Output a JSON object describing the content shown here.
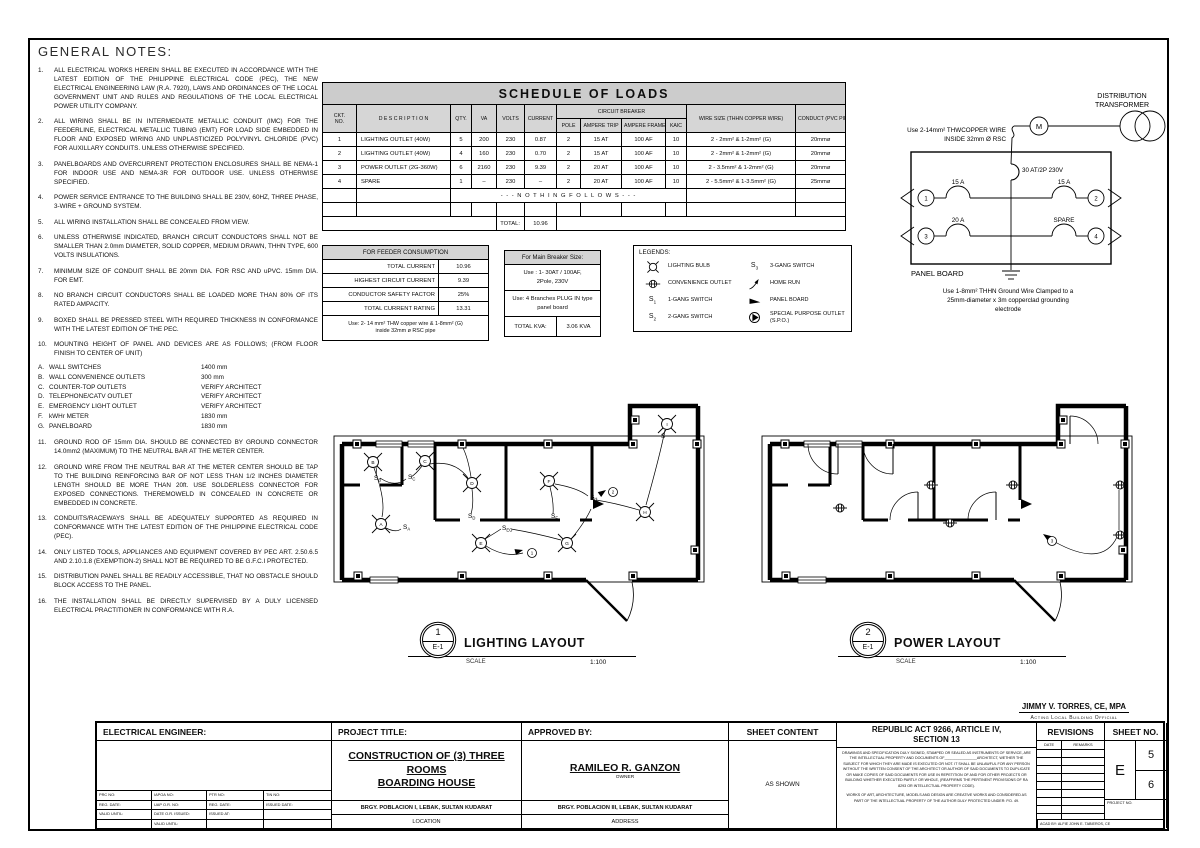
{
  "colors": {
    "paper": "#ffffff",
    "line": "#000000",
    "header_bg": "#cccccc"
  },
  "notes": {
    "title": "GENERAL NOTES:",
    "items": [
      {
        "no": "1.",
        "text": "ALL ELECTRICAL WORKS HEREIN SHALL BE EXECUTED IN ACCORDANCE WITH THE LATEST EDITION OF THE PHILIPPINE ELECTRICAL CODE (PEC), THE NEW ELECTRICAL ENGINEERING LAW (R.A. 7920), LAWS AND ORDINANCES OF THE LOCAL GOVERNMENT UNIT AND RULES AND REGULATIONS OF THE LOCAL ELECTRICAL POWER UTILITY COMPANY."
      },
      {
        "no": "2.",
        "text": "ALL WIRING SHALL BE IN INTERMEDIATE METALLIC CONDUIT (IMC) FOR THE FEEDERLINE, ELECTRICAL METALLIC TUBING (EMT) FOR LOAD SIDE EMBEDDED IN FLOOR AND EXPOSED WIRING AND UNPLASTICIZED POLYVINYL CHLORIDE (PVC) FOR AUXILLARY CONDUITS. UNLESS OTHERWISE SPECIFIED."
      },
      {
        "no": "3.",
        "text": "PANELBOARDS AND OVERCURRENT PROTECTION ENCLOSURES SHALL BE NEMA-1 FOR INDOOR USE AND NEMA-3R FOR OUTDOOR USE. UNLESS OTHERWISE SPECIFIED."
      },
      {
        "no": "4.",
        "text": "POWER SERVICE ENTRANCE TO THE BUILDING SHALL BE 230V, 60HZ, THREE PHASE, 3-WIRE + GROUND SYSTEM."
      },
      {
        "no": "5.",
        "text": "ALL WIRING INSTALLATION SHALL BE CONCEALED FROM VIEW."
      },
      {
        "no": "6.",
        "text": "UNLESS OTHERWISE INDICATED, BRANCH CIRCUIT CONDUCTORS SHALL NOT BE SMALLER THAN 2.0mm DIAMETER, SOLID COPPER, MEDIUM DRAWN, THHN TYPE, 600 VOLTS INSULATIONS."
      },
      {
        "no": "7.",
        "text": "MINIMUM SIZE OF CONDUIT SHALL BE 20mm DIA. FOR RSC AND uPVC. 15mm DIA. FOR EMT."
      },
      {
        "no": "8.",
        "text": "NO BRANCH CIRCUIT CONDUCTORS SHALL BE LOADED MORE THAN 80% OF ITS RATED AMPACITY."
      },
      {
        "no": "9.",
        "text": "BOXED SHALL BE PRESSED STEEL WITH REQUIRED THICKNESS IN CONFORMANCE WITH THE LATEST EDITION OF THE PEC."
      },
      {
        "no": "10.",
        "text": "MOUNTING HEIGHT OF PANEL AND DEVICES ARE AS FOLLOWS; (FROM FLOOR FINISH TO CENTER OF UNIT)"
      }
    ],
    "mounting": [
      {
        "key": "A.",
        "label": "WALL SWITCHES",
        "value": "1400 mm"
      },
      {
        "key": "B.",
        "label": "WALL CONVENIENCE OUTLETS",
        "value": "300 mm"
      },
      {
        "key": "C.",
        "label": "COUNTER-TOP OUTLETS",
        "value": "VERIFY ARCHITECT"
      },
      {
        "key": "D.",
        "label": "TELEPHONE/CATV OUTLET",
        "value": "VERIFY ARCHITECT"
      },
      {
        "key": "E.",
        "label": "EMERGENCY LIGHT OUTLET",
        "value": "VERIFY ARCHITECT"
      },
      {
        "key": "F.",
        "label": "kWHr METER",
        "value": "1830 mm"
      },
      {
        "key": "G.",
        "label": "PANELBOARD",
        "value": "1830 mm"
      }
    ],
    "items2": [
      {
        "no": "11.",
        "text": "GROUND ROD OF 15mm DIA. SHOULD BE CONNECTED BY GROUND CONNECTOR 14.0mm2 (MAXIMUM) TO THE NEUTRAL BAR AT THE METER CENTER."
      },
      {
        "no": "12.",
        "text": "GROUND WIRE FROM THE NEUTRAL BAR AT THE METER CENTER SHOULD BE TAP TO THE BUILDING REINFORCING BAR OF NOT LESS THAN 1/2 INCHES DIAMETER LENGTH SHOULD BE MORE THAN 20ft.  USE SOLDERLESS CONNECTOR FOR EXPOSED CONNECTIONS. THEREMOWELD IN CONCEALED IN CONCRETE OR EMBEDDED IN CONCRETE."
      },
      {
        "no": "13.",
        "text": "CONDUITS/RACEWAYS SHALL BE ADEQUATELY SUPPORTED AS REQUIRED IN CONFORMANCE WITH THE LATEST EDITION OF THE PHILIPPINE ELECTRICAL CODE (PEC)."
      },
      {
        "no": "14.",
        "text": "ONLY LISTED TOOLS, APPLIANCES AND EQUIPMENT COVERED BY PEC ART. 2.50.6.5 AND 2.10.1.8 (EXEMPTION-2) SHALL NOT BE REQUIRED TO BE G.F.C.I PROTECTED."
      },
      {
        "no": "15.",
        "text": "DISTRIBUTION PANEL SHALL BE READILY ACCESSIBLE, THAT NO OBSTACLE SHOULD BLOCK ACCESS TO THE PANEL."
      },
      {
        "no": "16.",
        "text": "THE INSTALLATION SHALL BE DIRECTLY SUPERVISED BY A DULY LICENSED ELECTRICAL PRACTITIONER IN CONFORMANCE WITH R.A."
      }
    ]
  },
  "schedule": {
    "title": "SCHEDULE OF LOADS",
    "headers": {
      "ckt1": "CKT.",
      "ckt2": "NO.",
      "desc": "D E S C R I P T I O N",
      "qty": "QTY.",
      "va": "VA",
      "volts": "VOLTS",
      "current": "CURRENT",
      "breaker": "CIRCUIT BREAKER",
      "pole": "POLE",
      "trip": "AMPERE TRIP",
      "frame": "AMPERE FRAME",
      "kaic": "KAIC",
      "wire": "WIRE SIZE (THHN COPPER WIRE)",
      "conduct": "CONDUCT (PVC PIPE)"
    },
    "rows": [
      [
        "1",
        "LIGHTING OUTLET (40W)",
        "5",
        "200",
        "230",
        "0.87",
        "2",
        "15 AT",
        "100 AF",
        "10",
        "2 - 2mm² & 1-2mm² (G)",
        "20mmø"
      ],
      [
        "2",
        "LIGHTING OUTLET (40W)",
        "4",
        "160",
        "230",
        "0.70",
        "2",
        "15 AT",
        "100 AF",
        "10",
        "2 - 2mm² & 1-2mm² (G)",
        "20mmø"
      ],
      [
        "3",
        "POWER OUTLET (2G-360W)",
        "6",
        "2160",
        "230",
        "9.39",
        "2",
        "20 AT",
        "100 AF",
        "10",
        "2 - 3.5mm² & 1-2mm² (G)",
        "20mmø"
      ],
      [
        "4",
        "SPARE",
        "1",
        "–",
        "230",
        "–",
        "2",
        "20 AT",
        "100 AF",
        "10",
        "2 - 5.5mm² & 1-3.5mm² (G)",
        "25mmø"
      ]
    ],
    "nothing_follows": "- - - N O T H I N G   F O L L O W S - - -",
    "total_label": "TOTAL:",
    "total_value": "10.96"
  },
  "feeder": {
    "title": "FOR FEEDER CONSUMPTION",
    "rows": [
      [
        "TOTAL CURRENT",
        "10.96"
      ],
      [
        "HIGHEST CIRCUIT CURRENT",
        "9.39"
      ],
      [
        "CONDUCTOR SAFETY FACTOR",
        "25%"
      ],
      [
        "TOTAL CURRENT RATING",
        "13.31"
      ]
    ],
    "note_line1": "Use: 2- 14 mm² THW copper wire & 1-8mm² (G)",
    "note_line2": "inside 32mm ø RSC pipe"
  },
  "main_breaker": {
    "title": "For Main Breaker Size:",
    "use1_line1": "Use : 1- 30AT / 100AF,",
    "use1_line2": "2Pole, 230V",
    "use2_line1": "Use: 4 Branches PLUG IN type",
    "use2_line2": "panel board",
    "total_label": "TOTAL KVA:",
    "total_value": "3.06 KVA"
  },
  "legends": {
    "title": "LEGENDS:",
    "left": [
      {
        "symbol": "bulb",
        "label": "LIGHTING BULB"
      },
      {
        "symbol": "outlet",
        "label": "CONVENIENCE OUTLET"
      },
      {
        "symbol": "s1",
        "label": "1-GANG SWITCH"
      },
      {
        "symbol": "s2",
        "label": "2-GANG SWITCH"
      }
    ],
    "right": [
      {
        "symbol": "s3",
        "label": "3-GANG SWITCH"
      },
      {
        "symbol": "homerun",
        "label": "HOME RUN"
      },
      {
        "symbol": "panel",
        "label": "PANEL BOARD"
      },
      {
        "symbol": "spo",
        "label": "SPECIAL PURPOSE OUTLET (S.P.O.)"
      }
    ]
  },
  "riser": {
    "transformer_line1": "DISTRIBUTION",
    "transformer_line2": "TRANSFORMER",
    "meter": "M",
    "feeder_note_line1": "Use 2-14mm² THWCOPPER WIRE",
    "feeder_note_line2": "INSIDE 32mm Ø RSC",
    "main_breaker": "30 AT/2P 230V",
    "circuits": [
      {
        "no": "1",
        "rating": "15 A",
        "side": "left",
        "row": 0
      },
      {
        "no": "2",
        "rating": "15 A",
        "side": "right",
        "row": 0
      },
      {
        "no": "3",
        "rating": "20 A",
        "side": "left",
        "row": 1
      },
      {
        "no": "4",
        "rating": "SPARE",
        "side": "right",
        "row": 1
      }
    ],
    "panel_label": "PANEL BOARD",
    "ground_note_line1": "Use 1-8mm² THHN Ground Wire Clamped to a",
    "ground_note_line2": "25mm-diameter x 3m copperclad grounding",
    "ground_note_line3": "electrode"
  },
  "plans": {
    "lighting": {
      "callout_no": "1",
      "callout_ref": "E-1",
      "title": "LIGHTING LAYOUT",
      "scale_label": "SCALE",
      "scale_value": "1:100",
      "fixtures": [
        {
          "label": "A",
          "x": 51,
          "y": 124
        },
        {
          "label": "B",
          "x": 43,
          "y": 62
        },
        {
          "label": "C",
          "x": 95,
          "y": 61
        },
        {
          "label": "D",
          "x": 142,
          "y": 83
        },
        {
          "label": "E",
          "x": 151,
          "y": 143
        },
        {
          "label": "F",
          "x": 219,
          "y": 81
        },
        {
          "label": "G",
          "x": 237,
          "y": 143
        },
        {
          "label": "H",
          "x": 315,
          "y": 112
        },
        {
          "label": "I",
          "x": 337,
          "y": 24
        }
      ],
      "switches": [
        {
          "sub": "B",
          "x": 44,
          "y": 80
        },
        {
          "sub": "C",
          "x": 78,
          "y": 79
        },
        {
          "sub": "A",
          "x": 73,
          "y": 129
        },
        {
          "sub": "D",
          "x": 138,
          "y": 118
        },
        {
          "sub": "EG",
          "x": 172,
          "y": 130
        },
        {
          "sub": "F",
          "x": 221,
          "y": 118
        },
        {
          "sub": "H",
          "x": 260,
          "y": 99
        },
        {
          "sub": "",
          "x": 331,
          "y": 38
        }
      ],
      "homeruns": [
        {
          "no": "1",
          "x": 202,
          "y": 153,
          "ax": 193,
          "ay": 150,
          "rot": -15
        },
        {
          "no": "2",
          "x": 283,
          "y": 92,
          "ax": 276,
          "ay": 90,
          "rot": -35
        }
      ]
    },
    "power": {
      "callout_no": "2",
      "callout_ref": "E-1",
      "title": "POWER LAYOUT",
      "scale_label": "SCALE",
      "scale_value": "1:100",
      "outlets": [
        {
          "x": 82,
          "y": 108
        },
        {
          "x": 173,
          "y": 85
        },
        {
          "x": 192,
          "y": 123
        },
        {
          "x": 255,
          "y": 85
        },
        {
          "x": 362,
          "y": 85
        },
        {
          "x": 362,
          "y": 135
        }
      ],
      "homeruns": [
        {
          "no": "3",
          "x": 294,
          "y": 141,
          "ax": 285,
          "ay": 134,
          "rot": 215
        }
      ]
    }
  },
  "signature": {
    "name": "JIMMY V. TORRES, CE, MPA",
    "title": "Acting Local Building Official"
  },
  "titleblock": {
    "engineer": {
      "header": "ELECTRICAL ENGINEER:",
      "fields": [
        [
          "PRC NO:",
          "IAPOA NO:",
          "PTR NO:",
          "TIN NO:"
        ],
        [
          "REG. DATE:",
          "UAP O.R. NO:",
          "REG. DATE:",
          "ISSUED DATE:"
        ],
        [
          "VALID UNTIL:",
          "DATE O.R.  ISSUED:",
          "ISSUED AT:",
          ""
        ],
        [
          "",
          "VALID UNTIL:",
          "",
          ""
        ]
      ]
    },
    "project": {
      "header": "PROJECT TITLE:",
      "title_line1": "CONSTRUCTION OF (3) THREE ROOMS",
      "title_line2": "BOARDING HOUSE",
      "location": "BRGY. POBLACION I, LEBAK, SULTAN KUDARAT",
      "location_label": "LOCATION"
    },
    "approved": {
      "header": "APPROVED BY:",
      "name": "RAMILEO R. GANZON",
      "role": "OWNER",
      "address": "BRGY. POBLACION III, LEBAK, SULTAN KUDARAT",
      "address_label": "ADDRESS"
    },
    "sheet_content": {
      "header": "SHEET CONTENT",
      "value": "AS SHOWN"
    },
    "republic_act": {
      "header_line1": "REPUBLIC ACT 9266, ARTICLE IV,",
      "header_line2": "SECTION 13",
      "para1": "DRAWINGS AND SPECIFICATION DULY SIGNED, STAMPED OR SEALED AS INSTRUMENTS OF SERVICE, ARE THE INTELLECTUAL PROPERTY AND DOCUMENTS OF________________ARCHITECT, WETHER THE SUBJECT FOR WHICH THEY ARE MADE IS EXECUTED OR NOT. IT SHALL BE UNLAWFUL FOR ANY PERSON WITHOUT THE WRITTEN CONSENT OF THE ARCHITECT OR AUTHOR OF SAID DOCUMENTS TO DUPLICATE OR MAKE COPIES OF SAID DOCUMENTS FOR USE IN REPETITION OF AND FOR OTHER PROJECTS OR BUILDING WHETHER EXECUTED PARTLY OR WHOLE, (REAFFIRMS THE PERTINENT PROVISIONS OF RA 8293 OR INTELLECTUAL PROPERTY CODE).",
      "para2": "WORKS OF ART, ARCHITECTURE, MODELS AND DESIGN ARE CREATIVE WORKS AND CONSIDERED AS PART OF THE INTELLECTUAL PROPERTY OF THE AUTHOR DULY PROTECTED UNDER: P.D. 49."
    },
    "revisions": {
      "header": "REVISIONS",
      "col1": "DATE",
      "col2": "REMARKS",
      "empty_rows": 10,
      "acad_by": "ACAD BY: ALFIE JOHN E. TABIEROS, CE"
    },
    "sheet_no": {
      "header": "SHEET NO.",
      "series": "E",
      "num1": "5",
      "num2": "6",
      "project_no_label": "PROJECT NO."
    }
  }
}
